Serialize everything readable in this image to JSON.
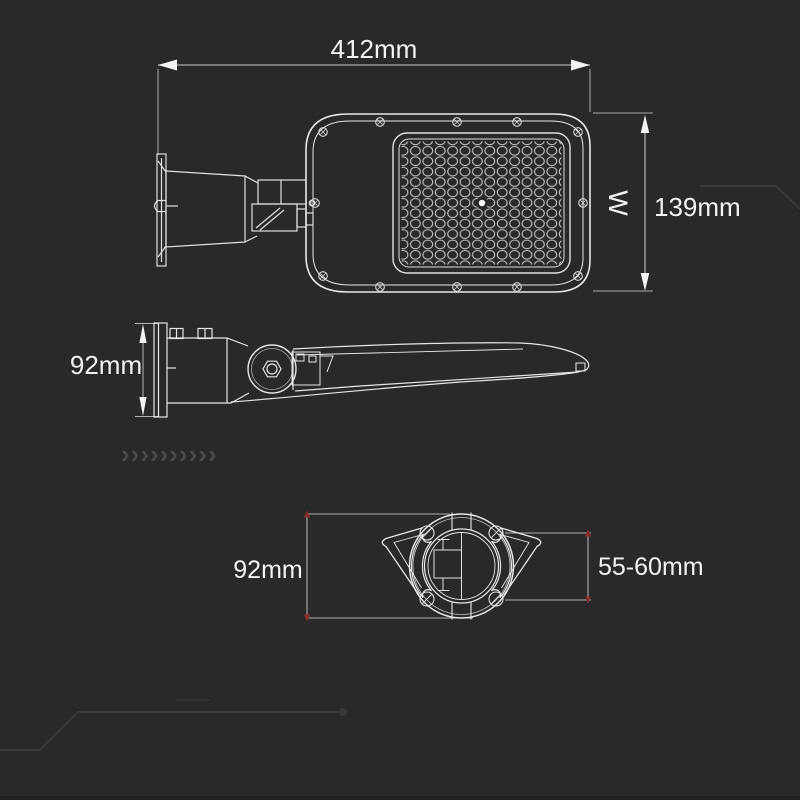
{
  "page": {
    "background_color": "#292929",
    "object_line_color": "#e8e8e8",
    "dimension_line_color": "#a8a8a8",
    "text_color": "#f3f3f3",
    "dimension_tick_red": "#8a2b2b",
    "decor_trace_color": "#3b3b3b"
  },
  "drawing": {
    "top_view": {
      "length_dimension": "412mm",
      "height_dimension": "139mm",
      "width_symbol": "W"
    },
    "side_view": {
      "height_dimension": "92mm"
    },
    "bottom_view": {
      "width_dimension": "92mm",
      "pole_diameter_dimension": "55-60mm"
    }
  },
  "decor": {
    "chevrons": "››››››››››"
  }
}
